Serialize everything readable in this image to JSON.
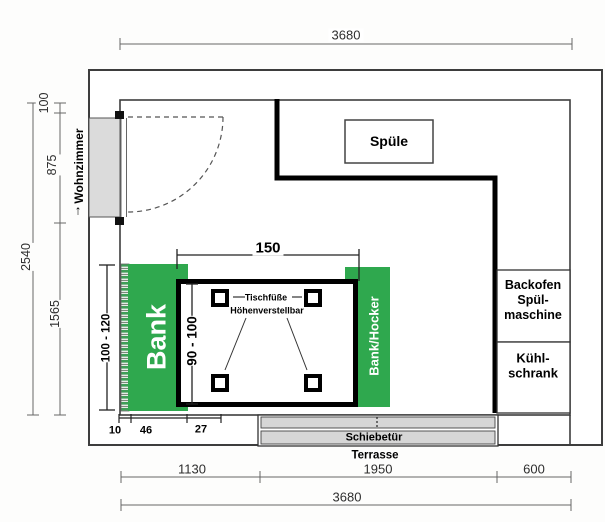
{
  "plan": {
    "room_dims": {
      "top_width": "3680",
      "bottom_width_total": "3680",
      "bottom_segments": [
        "1130",
        "1950",
        "600"
      ],
      "left_height_total": "2540",
      "left_segments": [
        "100",
        "875",
        "1565"
      ]
    },
    "adjacent": {
      "living_room": "Wohnzimmer",
      "living_room_arrow": "↑",
      "terrace": "Terrasse"
    },
    "fixtures": {
      "sink": "Spüle",
      "oven_dishwasher": [
        "Backofen",
        "Spül-",
        "maschine"
      ],
      "fridge": [
        "Kühl-",
        "schrank"
      ],
      "sliding_door": "Schiebetür"
    },
    "seating": {
      "bench_left": "Bank",
      "bench_right": "Bank/Hocker",
      "bench_height_range": "100 - 120",
      "bench_detail_dims": [
        "10",
        "46",
        "27"
      ]
    },
    "table": {
      "width": "150",
      "height_range": "90 - 100",
      "feet_note": [
        "Tischfüße",
        "Höhenverstellbar"
      ]
    }
  },
  "colors": {
    "bench_green": "#2fa84e",
    "wall_line": "#3d3d3d",
    "counter_line": "#000000",
    "door_fill": "#dbdbdb",
    "sliding_door_fill": "#d6d6d6",
    "dim_line": "#666666"
  }
}
